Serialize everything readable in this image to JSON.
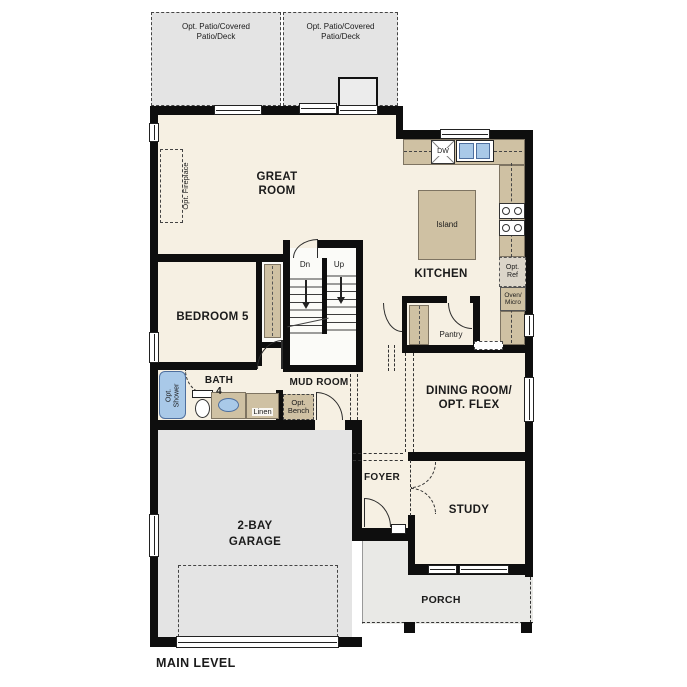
{
  "title": "MAIN LEVEL",
  "colors": {
    "wall": "#0e0e0e",
    "floor": "#f6f0e3",
    "cabinet_tan": "#cfc1a3",
    "patio_gray": "#e4e4e4",
    "porch_gray": "#e9e9e6",
    "fixture_blue": "#a9c9e8"
  },
  "areas": {
    "patio_left": {
      "label": "Opt. Patio/Covered\nPatio/Deck"
    },
    "patio_right": {
      "label": "Opt. Patio/Covered\nPatio/Deck"
    },
    "great_room": {
      "label": "GREAT\nROOM"
    },
    "kitchen": {
      "label": "KITCHEN"
    },
    "bedroom5": {
      "label": "BEDROOM 5"
    },
    "bath4": {
      "label": "BATH\n4"
    },
    "mud_room": {
      "label": "MUD ROOM"
    },
    "dining": {
      "label": "DINING ROOM/\nOPT. FLEX"
    },
    "foyer": {
      "label": "FOYER"
    },
    "study": {
      "label": "STUDY"
    },
    "garage": {
      "label": "2-BAY\nGARAGE"
    },
    "porch": {
      "label": "PORCH"
    },
    "pantry": {
      "label": "Pantry"
    }
  },
  "features": {
    "opt_fireplace": "Opt. Fireplace",
    "island": "Island",
    "dishwasher": "DW",
    "opt_ref": "Opt.\nRef",
    "oven_micro": "Oven/\nMicro",
    "opt_shower": "Opt.\nShower",
    "linen": "Linen",
    "opt_bench": "Opt.\nBench",
    "stairs_down": "Dn",
    "stairs_up": "Up"
  }
}
